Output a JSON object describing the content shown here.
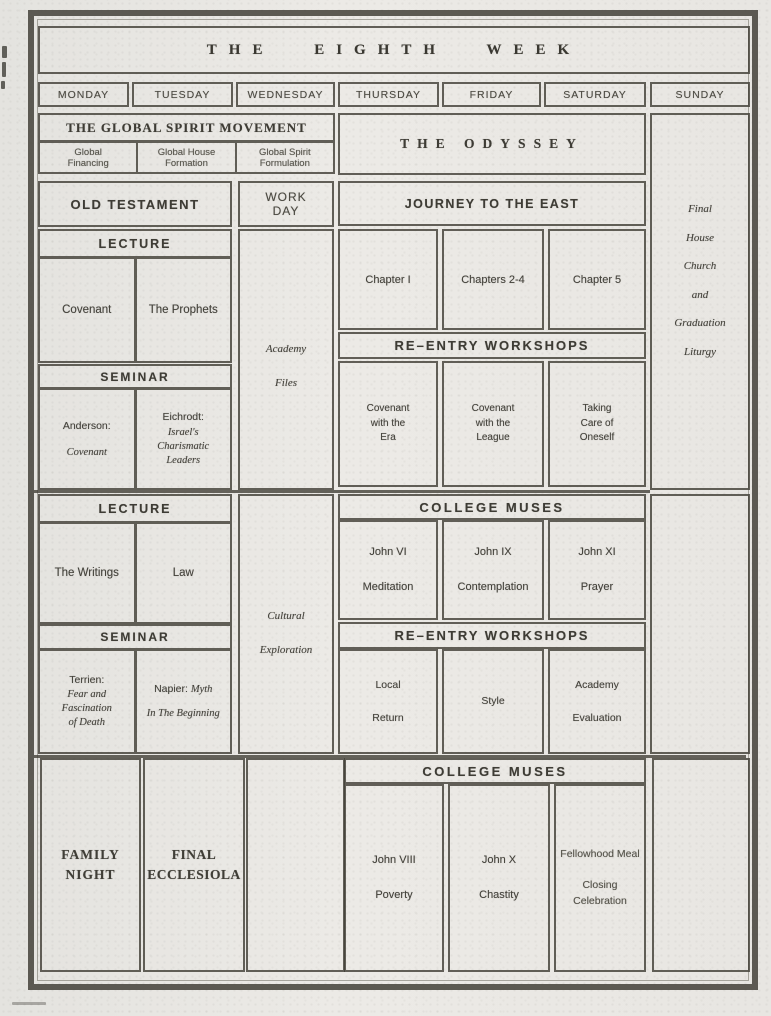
{
  "page": {
    "title": "THE EIGHTH WEEK",
    "days": [
      "MONDAY",
      "TUESDAY",
      "WEDNESDAY",
      "THURSDAY",
      "FRIDAY",
      "SATURDAY",
      "SUNDAY"
    ]
  },
  "spirit": {
    "header": "THE GLOBAL SPIRIT MOVEMENT",
    "cells": [
      "Global\nFinancing",
      "Global House\nFormation",
      "Global Spirit\nFormulation"
    ]
  },
  "odyssey": {
    "title": "THE ODYSSEY"
  },
  "old_testament": {
    "title": "OLD TESTAMENT"
  },
  "work_day": {
    "title": "WORK\nDAY"
  },
  "journey": {
    "title": "JOURNEY TO THE EAST"
  },
  "sunday": {
    "note": "Final\nHouse\nChurch\nand\nGraduation\nLiturgy"
  },
  "wednesday": {
    "morning": "Academy\n\nFiles",
    "afternoon": "Cultural\n\nExploration"
  },
  "block1": {
    "lecture": {
      "header": "LECTURE",
      "cells": [
        "Covenant",
        "The Prophets"
      ]
    },
    "seminar": {
      "header": "SEMINAR",
      "cells": [
        {
          "speaker": "Anderson:",
          "work": "Covenant"
        },
        {
          "speaker": "Eichrodt:",
          "work": "Israel's\nCharismatic\nLeaders"
        }
      ]
    },
    "chapters": [
      "Chapter I",
      "Chapters 2-4",
      "Chapter 5"
    ],
    "reentry": {
      "header": "RE–ENTRY WORKSHOPS",
      "cells": [
        "Covenant\nwith the\nEra",
        "Covenant\nwith the\nLeague",
        "Taking\nCare of\nOneself"
      ]
    }
  },
  "block2": {
    "lecture": {
      "header": "LECTURE",
      "cells": [
        "The Writings",
        "Law"
      ]
    },
    "seminar": {
      "header": "SEMINAR",
      "cells": [
        {
          "speaker": "Terrien:",
          "work": "Fear and\nFascination\nof Death"
        },
        {
          "speaker": "Napier:",
          "work": "Myth\nIn The Beginning"
        }
      ]
    },
    "muses": {
      "header": "COLLEGE MUSES",
      "cells": [
        "John VI\n\nMeditation",
        "John IX\n\nContemplation",
        "John XI\n\nPrayer"
      ]
    },
    "reentry": {
      "header": "RE–ENTRY WORKSHOPS",
      "cells": [
        "Local\n\nReturn",
        "Style",
        "Academy\n\nEvaluation"
      ]
    }
  },
  "block3": {
    "family_night": "FAMILY\nNIGHT",
    "final_ecclesiola": "FINAL\nECCLESIOLA",
    "muses": {
      "header": "COLLEGE MUSES",
      "cells": [
        "John VIII\n\nPoverty",
        "John X\n\nChastity",
        "Fellowhood Meal\n\nClosing\nCelebration"
      ]
    }
  }
}
